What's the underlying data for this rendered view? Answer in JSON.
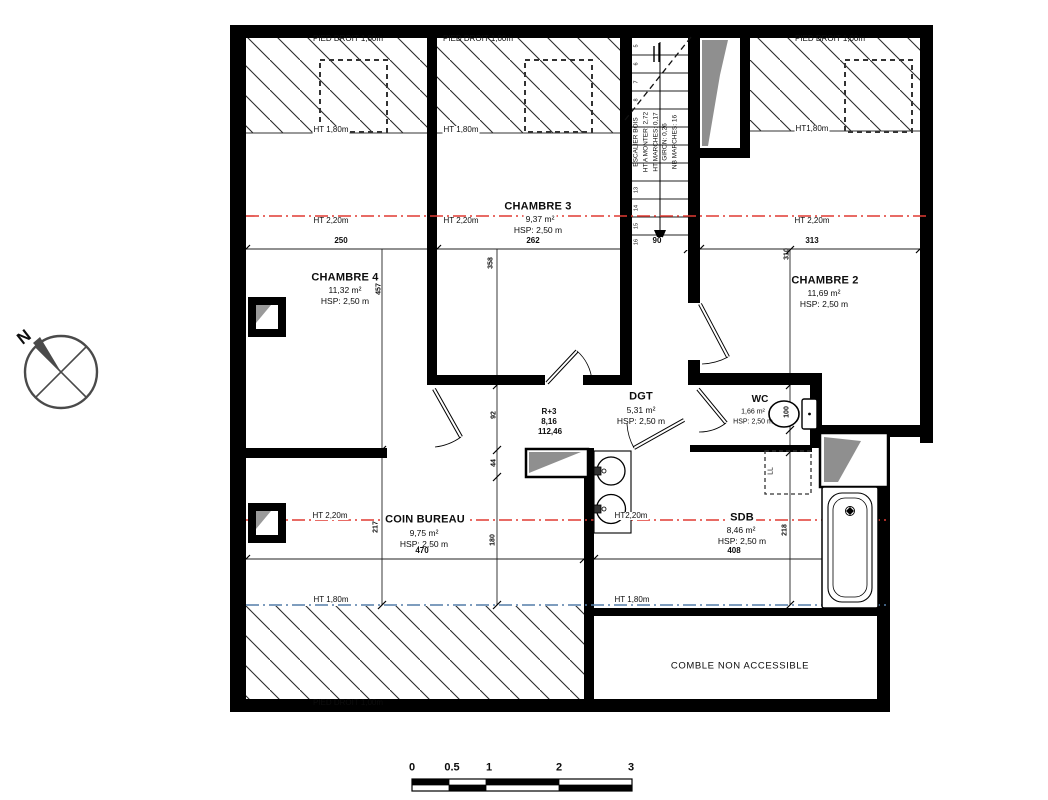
{
  "plan": {
    "rooms": {
      "chambre3": {
        "name": "CHAMBRE 3",
        "area": "9,37 m²",
        "hsp": "HSP: 2,50 m"
      },
      "chambre4": {
        "name": "CHAMBRE 4",
        "area": "11,32 m²",
        "hsp": "HSP: 2,50 m"
      },
      "chambre2": {
        "name": "CHAMBRE 2",
        "area": "11,69 m²",
        "hsp": "HSP: 2,50 m"
      },
      "dgt": {
        "name": "DGT",
        "area": "5,31 m²",
        "hsp": "HSP: 2,50 m"
      },
      "wc": {
        "name": "WC",
        "area": "1,66 m²",
        "hsp": "HSP: 2,50 m"
      },
      "coin_bureau": {
        "name": "COIN BUREAU",
        "area": "9,75 m²",
        "hsp": "HSP: 2,50 m"
      },
      "sdb": {
        "name": "SDB",
        "area": "8,46 m²",
        "hsp": "HSP: 2,50 m"
      },
      "comble": {
        "name": "COMBLE NON ACCESSIBLE"
      }
    },
    "level_marker": {
      "level": "R+3",
      "altitude": "8,16",
      "total_area": "112,46"
    },
    "stairs": {
      "label": "ESCALIER BOIS",
      "ht_a_monter": "HT A MONTER: 2,72",
      "ht_marches": "HT MARCHES: 0,17",
      "giron": "GIRON: 0,26",
      "nb_marches": "NB MARCHES: 16",
      "steps": [
        "5",
        "6",
        "7",
        "8",
        "13",
        "14",
        "15",
        "16"
      ]
    },
    "annotations": {
      "pied_droit": "PIED DROIT 1,00m",
      "ht180": "HT 1,80m",
      "ht180_tight": "HT1,80m",
      "ht220": "HT 2,20m",
      "ht220_tight": "HT2,20m",
      "ll": "LL",
      "north": "N"
    },
    "dimensions": {
      "d250": "250",
      "d262": "262",
      "d90": "90",
      "d313": "313",
      "d470": "470",
      "d408": "408",
      "v457": "457",
      "v358": "358",
      "v310": "310",
      "v217": "217",
      "v92": "92",
      "v44": "44",
      "v180": "180",
      "v100": "100",
      "v218": "218"
    },
    "scale_bar": [
      "0",
      "0.5",
      "1",
      "2",
      "3"
    ],
    "colors": {
      "red_height_line": "#e03a32",
      "blue_height_line": "#537da8",
      "wall": "#000000",
      "shade_gray": "#8f8f8f"
    }
  }
}
